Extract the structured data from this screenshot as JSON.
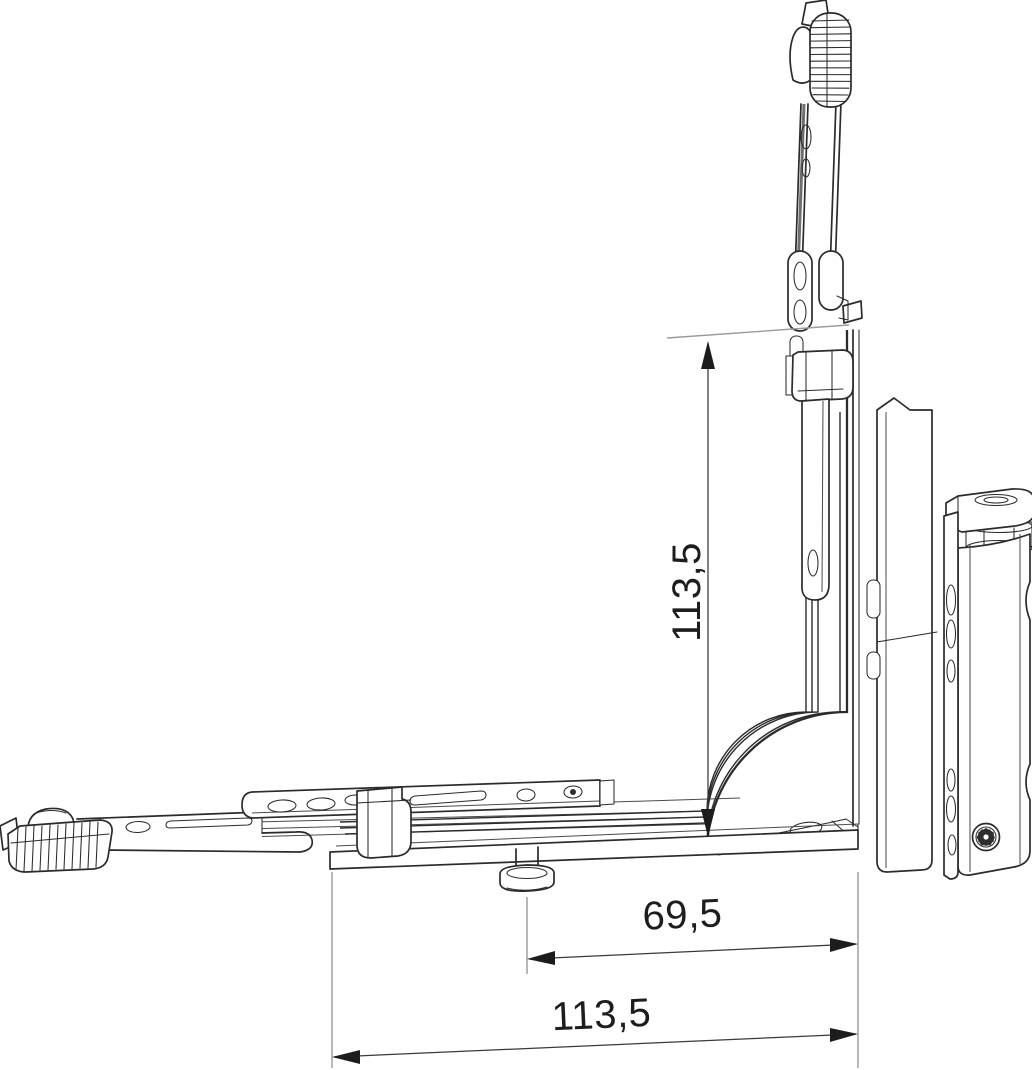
{
  "figure": {
    "type": "technical line drawing",
    "subject": "corner hinge hardware with dimension annotations",
    "background": "#ffffff",
    "line_color": "#2b2b2b",
    "dimension_text_color": "#1d1d1d"
  },
  "dimension_labels": {
    "vertical": "113,5",
    "horizontal_upper": "69,5",
    "horizontal_lower": "113,5"
  },
  "parts": [
    "toothed-rack-head-top",
    "vertical-drive-rod",
    "link-plate",
    "transfer-clamp",
    "vertical-faceplate-rail",
    "mounting-back-plate",
    "frame-hinge-body",
    "torx-screw",
    "corner-drive-band",
    "corner-bracket",
    "faceplate-rail-bottom",
    "slider-bar",
    "slider-clamp",
    "mushroom-cam-pin",
    "horizontal-drive-rod",
    "toothed-rack-head-left"
  ]
}
